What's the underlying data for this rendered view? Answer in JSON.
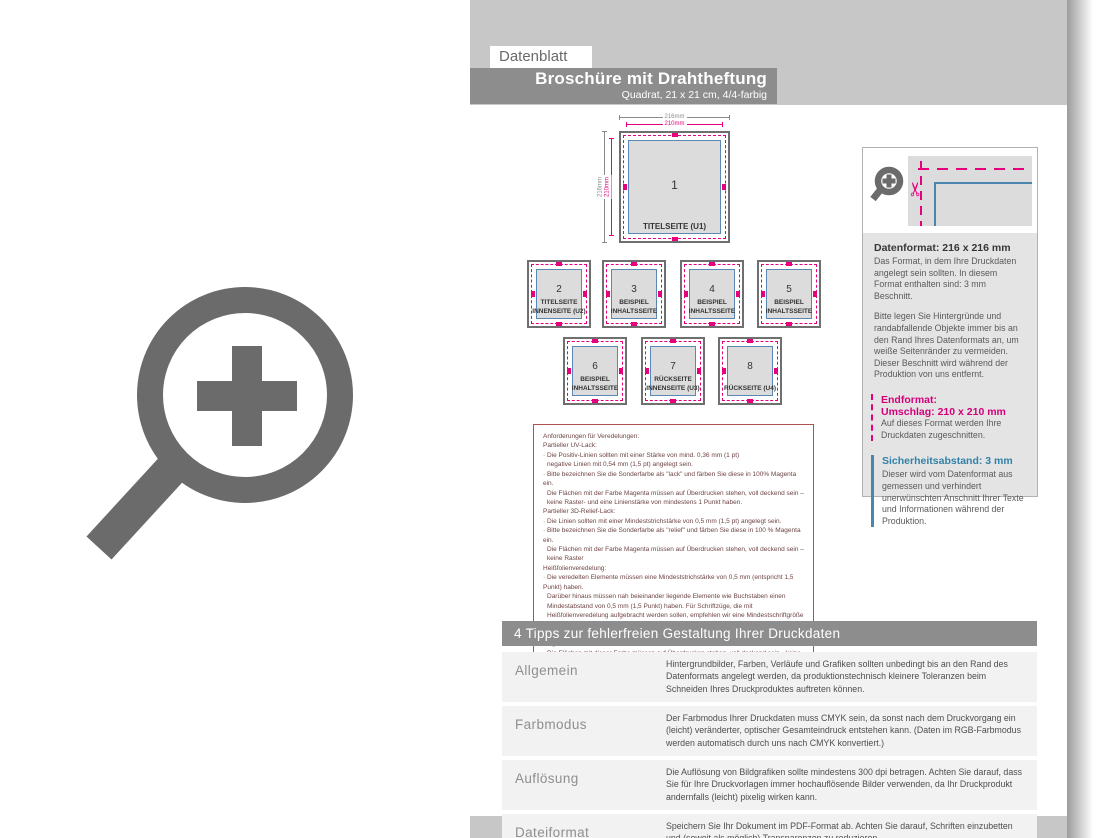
{
  "header": {
    "tab": "Datenblatt",
    "title": "Broschüre mit Drahtheftung",
    "subtitle": "Quadrat, 21 x 21 cm, 4/4-farbig"
  },
  "dims": {
    "outer": "216mm",
    "inner": "210mm"
  },
  "squares": [
    {
      "num": "1",
      "caption": "TITELSEITE (U1)"
    },
    {
      "num": "2",
      "caption": "TITELSEITE\nINNENSEITE (U2)"
    },
    {
      "num": "3",
      "caption": "BEISPIEL\nINHALTSSEITE"
    },
    {
      "num": "4",
      "caption": "BEISPIEL\nINHALTSSEITE"
    },
    {
      "num": "5",
      "caption": "BEISPIEL\nINHALTSSEITE"
    },
    {
      "num": "6",
      "caption": "BEISPIEL\nINHALTSSEITE"
    },
    {
      "num": "7",
      "caption": "RÜCKSEITE\nINNENSEITE (U3)"
    },
    {
      "num": "8",
      "caption": "RÜCKSEITE (U4)"
    }
  ],
  "redbox": {
    "lines": [
      {
        "text": "Anforderungen für Veredelungen:"
      },
      {
        "text": "Partieller UV-Lack:"
      },
      {
        "text": "· Die Positiv-Linien sollten mit einer Stärke von mind. 0,36 mm (1 pt)"
      },
      {
        "text": "negative Linien mit 0,54 mm (1,5 pt) angelegt sein."
      },
      {
        "text": "· Bitte bezeichnen Sie die Sonderfarbe als \"lack\" und färben Sie diese in 100% Magenta ein."
      },
      {
        "text": "Die Flächen mit der Farbe Magenta müssen auf Überdrucken stehen, voll deckend sein – keine Raster- und eine Linienstärke von mindestens 1 Punkt haben."
      },
      {
        "text": "Partieller 3D-Relief-Lack:"
      },
      {
        "text": "· Die Linien sollten mit einer Mindeststrichstärke von 0,5 mm (1,5 pt) angelegt sein."
      },
      {
        "text": "· Bitte bezeichnen Sie die Sonderfarbe als \"relief\" und färben Sie diese in 100 % Magenta ein."
      },
      {
        "text": "Die Flächen mit der Farbe Magenta müssen auf Überdrucken stehen, voll deckend sein – keine Raster"
      },
      {
        "text": "Heißfolienveredelung:"
      },
      {
        "text": "· Die veredelten Elemente müssen eine Mindeststrichstärke von 0,5 mm (entspricht 1,5 Punkt) haben."
      },
      {
        "text": "Darüber hinaus müssen nah beieinander liegende Elemente wie Buchstaben einen Mindestabstand von 0,5 mm (1,5 Punkt) haben. Für Schriftzüge, die mit Heißfolienveredelung aufgebracht werden sollen, empfehlen wir eine Mindestschriftgröße von 10 Punkt."
      },
      {
        "text": "· Bitte bezeichnen Sie die Sonderfarbe als „praegung“ und färben Sie diese in 100% Magenta."
      },
      {
        "text": "Die Flächen mit dieser Farbe müssen auf Überdrucken stehen, voll deckend sein - keine Raster"
      }
    ]
  },
  "panel": {
    "datenformat_title": "Datenformat: 216 x 216 mm",
    "datenformat_p1": "Das Format, in dem Ihre Druckdaten angelegt sein sollten. In diesem Format enthalten sind: 3 mm Beschnitt.",
    "datenformat_p2": "Bitte legen Sie Hintergründe und randabfallende Objekte immer bis an den Rand Ihres Datenformats an, um weiße Seitenränder zu vermeiden. Dieser Beschnitt wird während der Produktion von uns entfernt.",
    "endformat_title1": "Endformat:",
    "endformat_title2": "Umschlag: 210 x 210 mm",
    "endformat_body": "Auf dieses Format werden Ihre Druckdaten zugeschnitten.",
    "sicherheit_title": "Sicherheitsabstand: 3 mm",
    "sicherheit_body": "Dieser wird vom Datenformat aus gemessen und verhindert unerwünschten Anschnitt Ihrer Texte und Informationen während der Produktion."
  },
  "tips": {
    "header": "4 Tipps zur fehlerfreien Gestaltung Ihrer Druckdaten",
    "rows": [
      {
        "label": "Allgemein",
        "text": "Hintergrundbilder, Farben, Verläufe und Grafiken sollten unbedingt bis an den Rand des Datenformats angelegt werden, da produktionstechnisch kleinere Toleranzen beim Schneiden Ihres Druckproduktes auftreten können."
      },
      {
        "label": "Farbmodus",
        "text": "Der Farbmodus Ihrer Druckdaten muss CMYK sein, da sonst nach dem Druckvorgang ein (leicht) veränderter, optischer Gesamteindruck entstehen kann. (Daten im RGB-Farbmodus werden automatisch durch uns nach CMYK konvertiert.)"
      },
      {
        "label": "Auflösung",
        "text": "Die Auflösung von Bildgrafiken sollte mindestens 300 dpi betragen. Achten Sie darauf, dass Sie für Ihre Druckvorlagen immer hochauflösende Bilder verwenden, da Ihr Druckprodukt andernfalls (leicht) pixelig wirken kann."
      },
      {
        "label": "Dateiformat",
        "text": "Speichern Sie Ihr Dokument im PDF-Format ab. Achten Sie darauf, Schriften einzubetten und (soweit als möglich) Transparenzen zu reduzieren."
      }
    ]
  },
  "icons": {
    "scissors": "✂",
    "zoom_in": "magnifier-plus"
  },
  "colors": {
    "magenta": "#e6007e",
    "blue": "#4a86ad",
    "banner_gray": "#8d8d8d",
    "backdrop_gray": "#c7c7c7",
    "red_border": "#b05050"
  }
}
